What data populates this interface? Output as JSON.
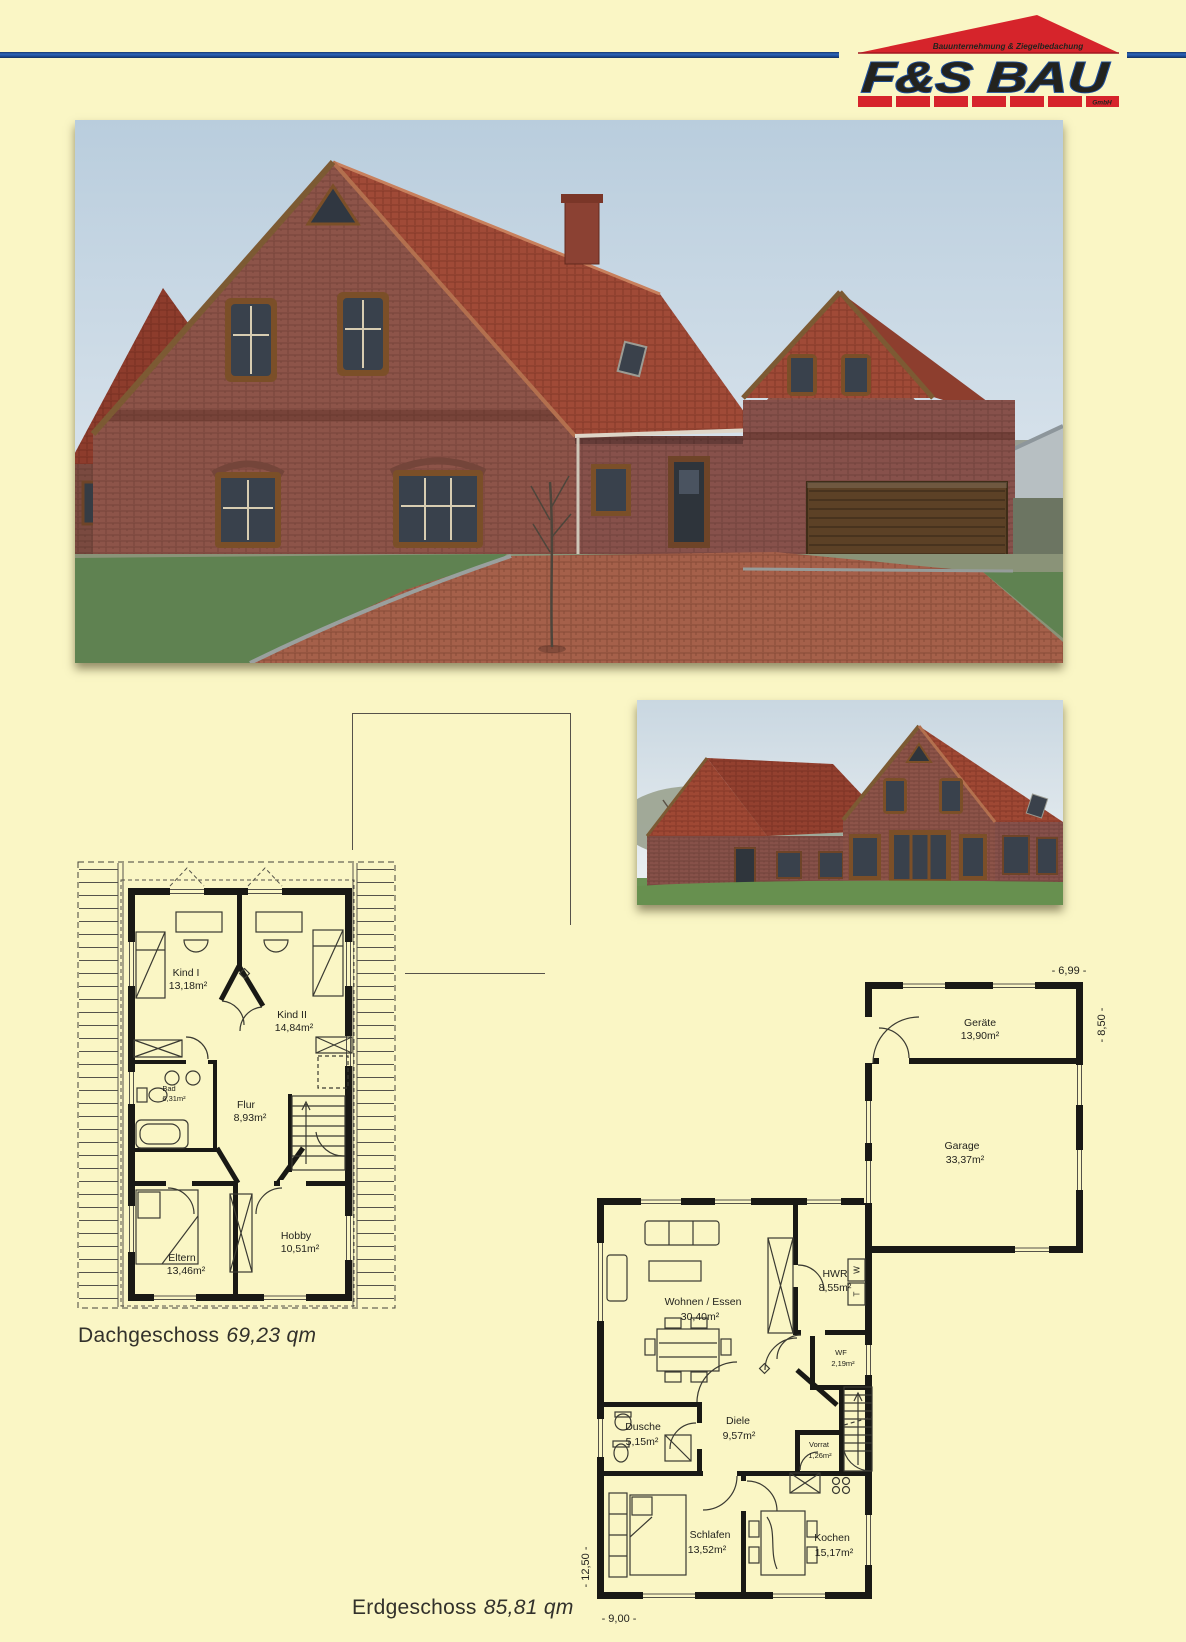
{
  "page": {
    "background": "#FAF6C5",
    "rule_blue": "#1D4F9E",
    "logo_red": "#D6242B"
  },
  "logo": {
    "tagline": "Bauunternehmung & Ziegelbedachung",
    "name": "F&S BAU",
    "suffix": "GmbH"
  },
  "plans": {
    "dg": {
      "caption": "Dachgeschoss",
      "area": "69,23 qm",
      "rooms": {
        "kind1": {
          "name": "Kind I",
          "area": "13,18m²"
        },
        "kind2": {
          "name": "Kind II",
          "area": "14,84m²"
        },
        "bad": {
          "name": "Bad",
          "area": "6,31m²"
        },
        "flur": {
          "name": "Flur",
          "area": "8,93m²"
        },
        "eltern": {
          "name": "Eltern",
          "area": "13,46m²"
        },
        "hobby": {
          "name": "Hobby",
          "area": "10,51m²"
        }
      }
    },
    "eg": {
      "caption": "Erdgeschoss",
      "area": "85,81 qm",
      "rooms": {
        "geraete": {
          "name": "Geräte",
          "area": "13,90m²"
        },
        "garage": {
          "name": "Garage",
          "area": "33,37m²"
        },
        "wohnen": {
          "name": "Wohnen / Essen",
          "area": "30,40m²"
        },
        "hwr": {
          "name": "HWR",
          "area": "8,55m²"
        },
        "wf": {
          "name": "WF",
          "area": "2,19m²"
        },
        "dusche": {
          "name": "Dusche",
          "area": "5,15m²"
        },
        "diele": {
          "name": "Diele",
          "area": "9,57m²"
        },
        "vorrat": {
          "name": "Vorrat",
          "area": "1,26m²"
        },
        "schlafen": {
          "name": "Schlafen",
          "area": "13,52m²"
        },
        "kochen": {
          "name": "Kochen",
          "area": "15,17m²"
        }
      },
      "dims": {
        "garage_width": "- 6,99 -",
        "garage_depth": "- 8,50 -",
        "house_depth": "- 12,50 -",
        "house_width": "- 9,00 -"
      },
      "appliances": {
        "washer": "W",
        "dryer": "T"
      }
    }
  }
}
